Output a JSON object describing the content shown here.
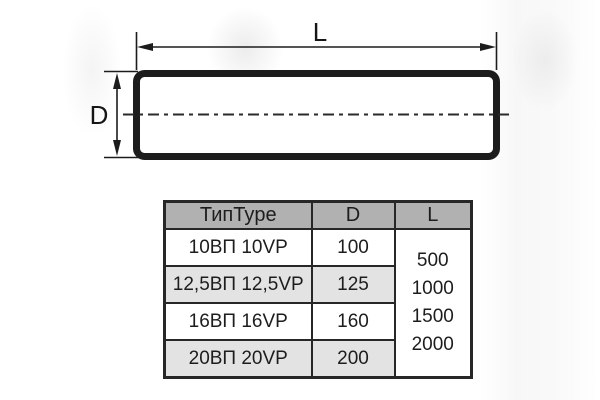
{
  "colors": {
    "background": "#ffffff",
    "line_color": "#1c1c1c",
    "table_header_bg": "#b1b1b1",
    "table_alt_row_bg": "#e3e3e3",
    "table_border": "#272727"
  },
  "diagram": {
    "description": "side view of round ventilation duct with dimension lines",
    "length_label": "L",
    "diameter_label": "D"
  },
  "table": {
    "headers": [
      "ТипType",
      "D",
      "L"
    ],
    "rows": [
      {
        "type": "10ВП 10VP",
        "d": "100"
      },
      {
        "type": "12,5ВП 12,5VP",
        "d": "125"
      },
      {
        "type": "16ВП 16VP",
        "d": "160"
      },
      {
        "type": "20ВП 20VP",
        "d": "200"
      }
    ],
    "l_values": [
      "500",
      "1000",
      "1500",
      "2000"
    ]
  }
}
